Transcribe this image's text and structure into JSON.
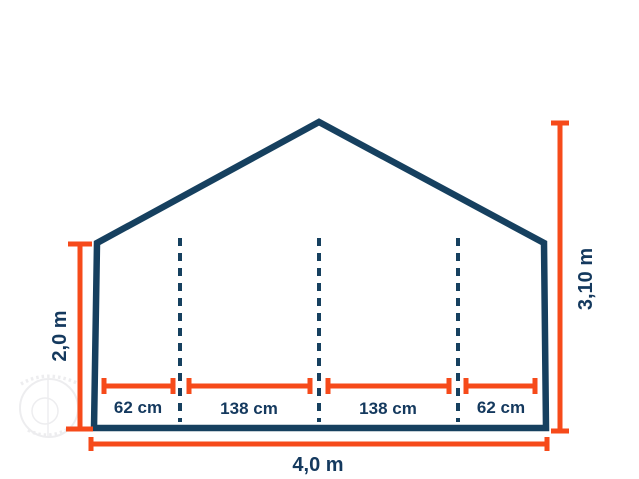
{
  "diagram": {
    "colors": {
      "structure": "#16405f",
      "dimension": "#f64a1a",
      "label": "#14395e",
      "watermark": "#e2e2e6"
    },
    "measurements": {
      "eave_height": "2,0 m",
      "ridge_height": "3,10 m",
      "total_width": "4,0 m",
      "bottom_segments": [
        "62 cm",
        "138 cm",
        "138 cm",
        "62 cm"
      ]
    }
  }
}
